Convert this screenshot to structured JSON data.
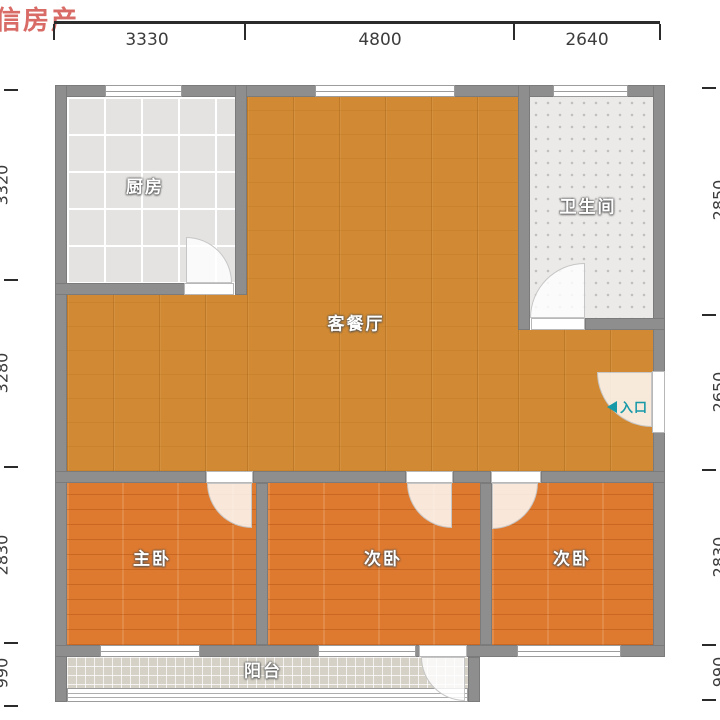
{
  "watermark": {
    "text": "信房产",
    "color": "#d96b66"
  },
  "dimensions": {
    "top": [
      "3330",
      "4800",
      "2640"
    ],
    "left": [
      "3320",
      "3280",
      "2830",
      "990"
    ],
    "right": [
      "2850",
      "2650",
      "2830",
      "990"
    ]
  },
  "rooms": {
    "kitchen": "厨房",
    "bathroom": "卫生间",
    "living_dining": "客餐厅",
    "master_bedroom": "主卧",
    "second_bedroom": "次卧",
    "third_bedroom": "次卧",
    "balcony": "阳台"
  },
  "entry": {
    "label": "入口",
    "color": "#1899a8"
  },
  "colors": {
    "wall": "#8e8e8e",
    "living_floor": "#d18a33",
    "bedroom_floor": "#de7a30",
    "dimension_text": "#3c3c3c",
    "entry_accent": "#1899a8",
    "watermark_red": "#d96b66"
  }
}
